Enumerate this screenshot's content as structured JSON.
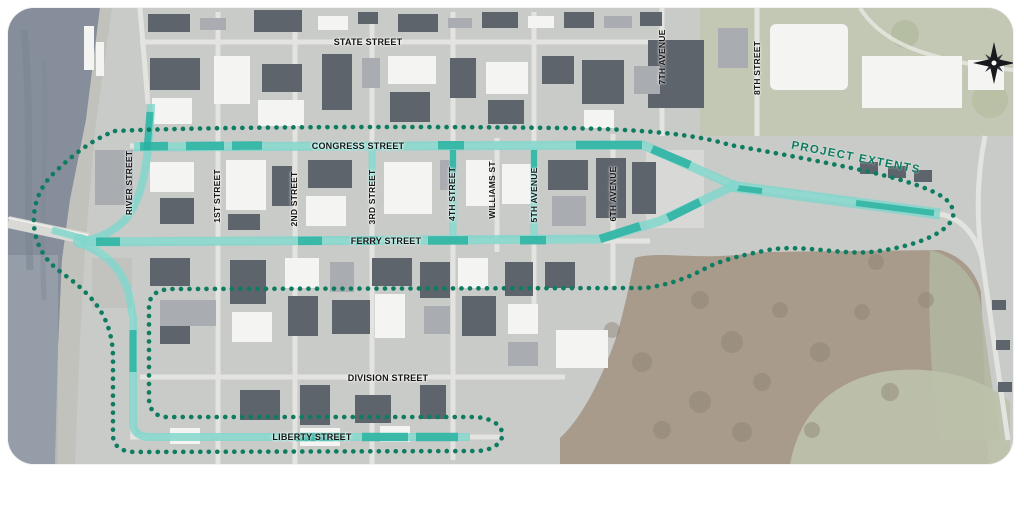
{
  "map": {
    "street_labels": {
      "state": "STATE STREET",
      "congress": "CONGRESS STREET",
      "ferry": "FERRY STREET",
      "division": "DIVISION STREET",
      "liberty": "LIBERTY STREET",
      "river": "RIVER STREET",
      "first": "1ST STREET",
      "second": "2ND STREET",
      "third": "3RD STREET",
      "fourth": "4TH STREET",
      "williams": "WILLIAMS ST",
      "fifth": "5TH AVENUE",
      "sixth": "6TH AVENUE",
      "seventh": "7TH AVENUE",
      "eighth": "8TH STREET"
    },
    "boundary_label": "PROJECT EXTENTS",
    "colors": {
      "boundary_dotted": "#0e7c60",
      "highlight_teal": "#82d7cd",
      "highlight_teal_dark": "#2ab1a1",
      "river": "#868e9b",
      "label_text": "#161616"
    },
    "compass": {
      "icon": "compass-rose"
    }
  }
}
